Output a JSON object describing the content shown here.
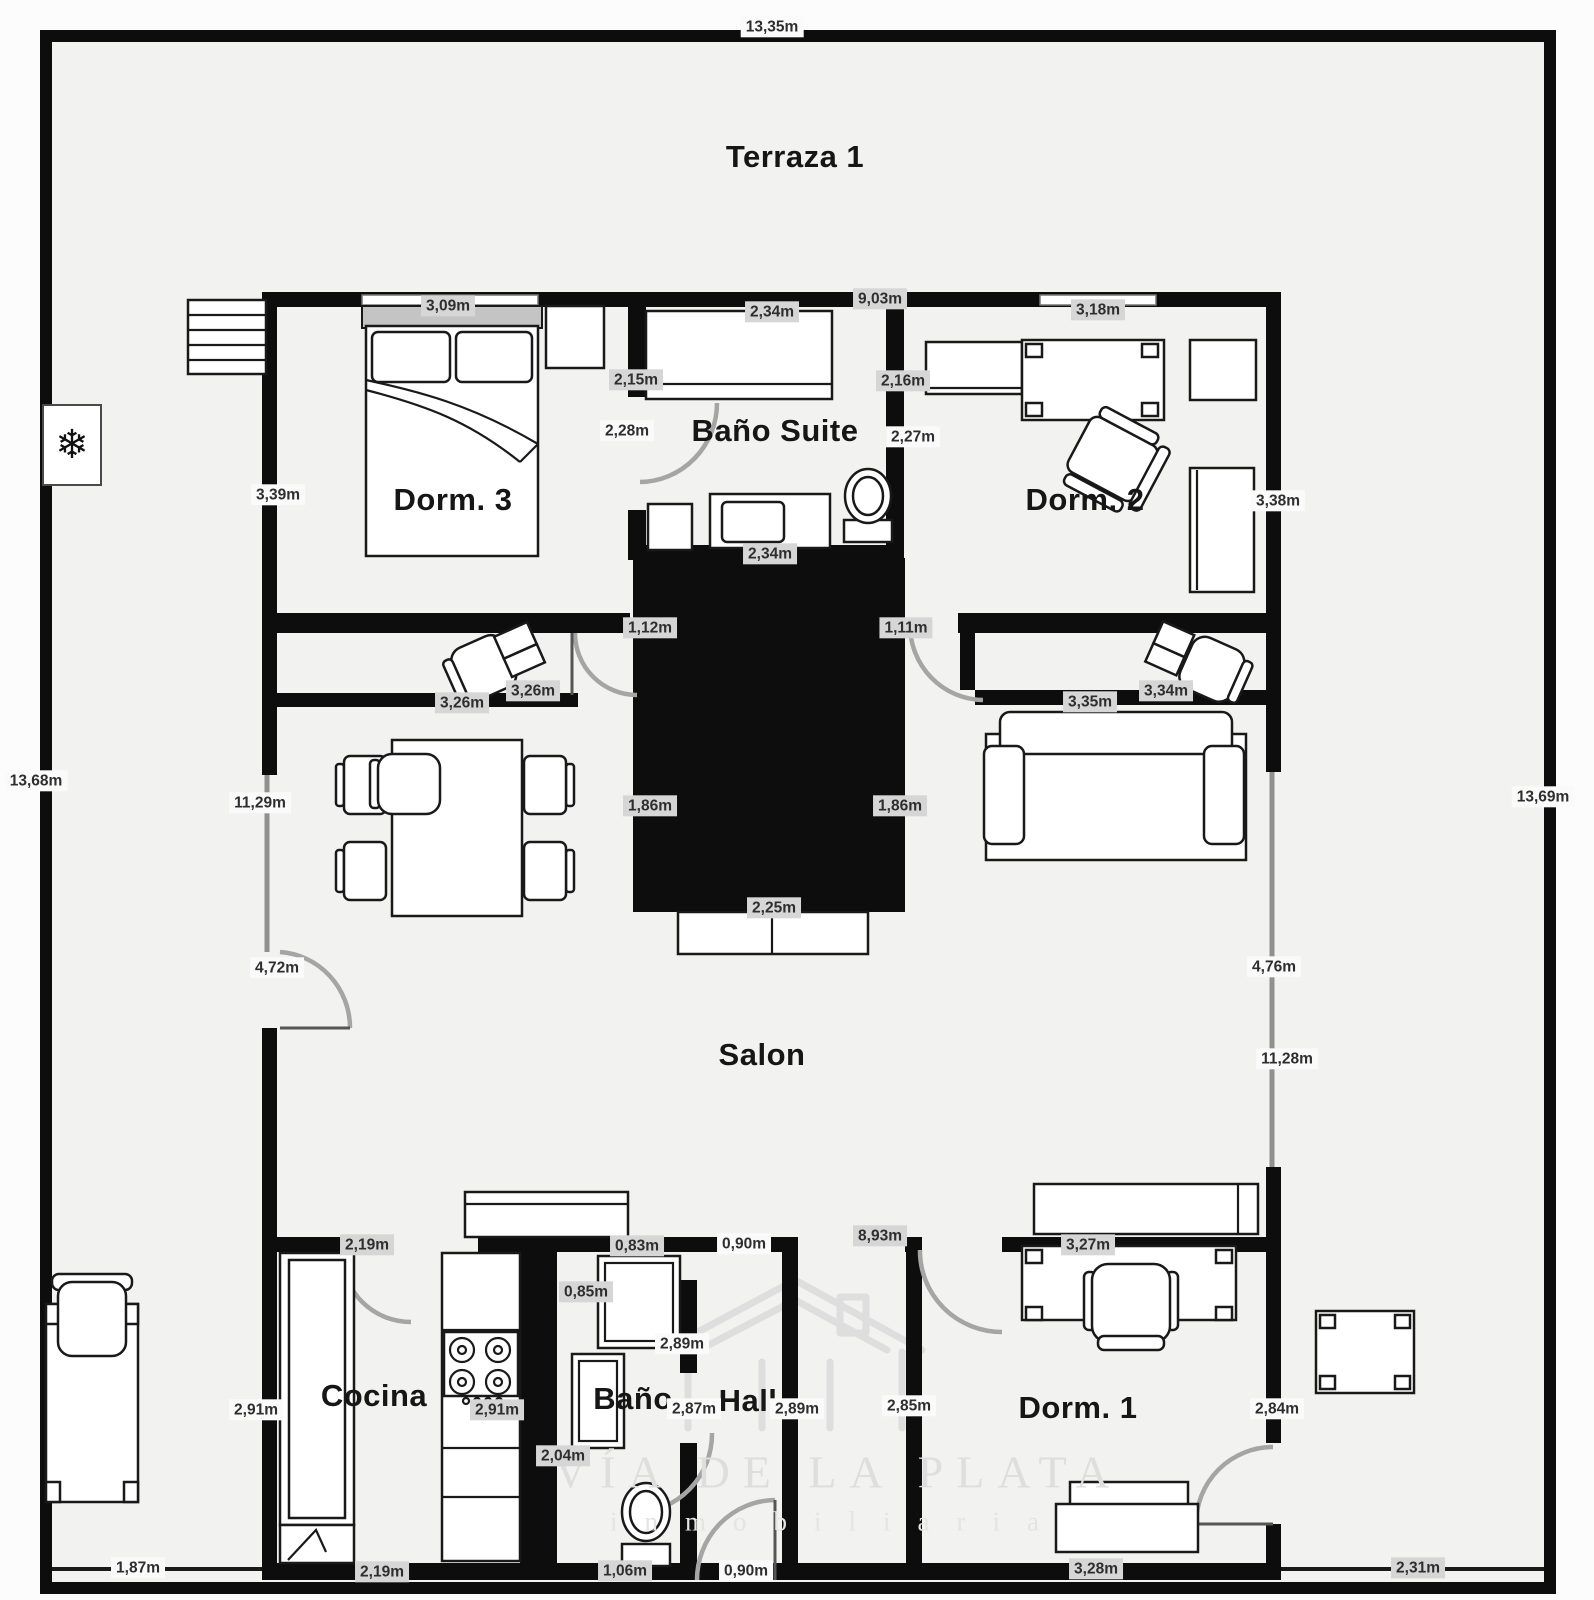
{
  "plan_title": "Floor plan",
  "watermark": {
    "line1": "VÍA DE LA PLATA",
    "line2": "inmobiliaria"
  },
  "icons": {
    "snowflake": "❄"
  },
  "colors": {
    "wall": "#0d0d0d",
    "floor": "#f2f2f1",
    "chip_background": "#d6d6d6",
    "plain_background": "#fafafa",
    "label_text": "#2e2e2e",
    "watermark": "#dedede"
  },
  "room_labels": [
    {
      "text": "Terraza 1",
      "x": 795,
      "y": 157
    },
    {
      "text": "Dorm. 3",
      "x": 453,
      "y": 500
    },
    {
      "text": "Baño Suite",
      "x": 775,
      "y": 431
    },
    {
      "text": "Dorm. 2",
      "x": 1085,
      "y": 500
    },
    {
      "text": "Salon",
      "x": 762,
      "y": 1055
    },
    {
      "text": "Cocina",
      "x": 374,
      "y": 1396
    },
    {
      "text": "Baño",
      "x": 633,
      "y": 1399
    },
    {
      "text": "Hall",
      "x": 748,
      "y": 1401
    },
    {
      "text": "Dorm. 1",
      "x": 1078,
      "y": 1408
    }
  ],
  "dimension_labels": [
    {
      "text": "13,35m",
      "x": 772,
      "y": 27,
      "style": "plain"
    },
    {
      "text": "13,68m",
      "x": 36,
      "y": 781,
      "style": "plain"
    },
    {
      "text": "13,69m",
      "x": 1543,
      "y": 797,
      "style": "plain"
    },
    {
      "text": "3,09m",
      "x": 448,
      "y": 306,
      "style": "chip"
    },
    {
      "text": "2,34m",
      "x": 772,
      "y": 312,
      "style": "chip"
    },
    {
      "text": "9,03m",
      "x": 880,
      "y": 299,
      "style": "chip"
    },
    {
      "text": "3,18m",
      "x": 1098,
      "y": 310,
      "style": "chip"
    },
    {
      "text": "2,15m",
      "x": 636,
      "y": 380,
      "style": "chip"
    },
    {
      "text": "2,16m",
      "x": 903,
      "y": 381,
      "style": "chip"
    },
    {
      "text": "2,28m",
      "x": 627,
      "y": 431,
      "style": "plain"
    },
    {
      "text": "2,27m",
      "x": 913,
      "y": 437,
      "style": "plain"
    },
    {
      "text": "3,39m",
      "x": 278,
      "y": 495,
      "style": "plain"
    },
    {
      "text": "3,38m",
      "x": 1278,
      "y": 501,
      "style": "plain"
    },
    {
      "text": "2,34m",
      "x": 770,
      "y": 554,
      "style": "chip"
    },
    {
      "text": "1,12m",
      "x": 650,
      "y": 628,
      "style": "chip"
    },
    {
      "text": "1,11m",
      "x": 906,
      "y": 628,
      "style": "chip"
    },
    {
      "text": "3,26m",
      "x": 533,
      "y": 691,
      "style": "chip"
    },
    {
      "text": "3,26m",
      "x": 462,
      "y": 703,
      "style": "chip"
    },
    {
      "text": "3,35m",
      "x": 1090,
      "y": 702,
      "style": "chip"
    },
    {
      "text": "3,34m",
      "x": 1166,
      "y": 691,
      "style": "chip"
    },
    {
      "text": "11,29m",
      "x": 260,
      "y": 803,
      "style": "plain"
    },
    {
      "text": "1,86m",
      "x": 650,
      "y": 806,
      "style": "chip"
    },
    {
      "text": "1,86m",
      "x": 900,
      "y": 806,
      "style": "chip"
    },
    {
      "text": "2,25m",
      "x": 774,
      "y": 908,
      "style": "chip"
    },
    {
      "text": "4,72m",
      "x": 277,
      "y": 968,
      "style": "plain"
    },
    {
      "text": "4,76m",
      "x": 1274,
      "y": 967,
      "style": "plain"
    },
    {
      "text": "11,28m",
      "x": 1287,
      "y": 1059,
      "style": "plain"
    },
    {
      "text": "2,19m",
      "x": 367,
      "y": 1245,
      "style": "chip"
    },
    {
      "text": "0,83m",
      "x": 637,
      "y": 1246,
      "style": "chip"
    },
    {
      "text": "0,90m",
      "x": 744,
      "y": 1244,
      "style": "plain"
    },
    {
      "text": "8,93m",
      "x": 880,
      "y": 1236,
      "style": "chip"
    },
    {
      "text": "3,27m",
      "x": 1088,
      "y": 1245,
      "style": "chip"
    },
    {
      "text": "2,91m",
      "x": 256,
      "y": 1410,
      "style": "plain"
    },
    {
      "text": "2,91m",
      "x": 497,
      "y": 1410,
      "style": "chip"
    },
    {
      "text": "0,85m",
      "x": 586,
      "y": 1292,
      "style": "chip"
    },
    {
      "text": "2,89m",
      "x": 682,
      "y": 1344,
      "style": "plain"
    },
    {
      "text": "2,87m",
      "x": 694,
      "y": 1409,
      "style": "plain"
    },
    {
      "text": "2,89m",
      "x": 797,
      "y": 1409,
      "style": "plain"
    },
    {
      "text": "2,85m",
      "x": 909,
      "y": 1406,
      "style": "plain"
    },
    {
      "text": "2,84m",
      "x": 1277,
      "y": 1409,
      "style": "plain"
    },
    {
      "text": "2,04m",
      "x": 563,
      "y": 1456,
      "style": "chip"
    },
    {
      "text": "1,87m",
      "x": 138,
      "y": 1568,
      "style": "plain"
    },
    {
      "text": "2,19m",
      "x": 382,
      "y": 1572,
      "style": "chip"
    },
    {
      "text": "1,06m",
      "x": 625,
      "y": 1571,
      "style": "chip"
    },
    {
      "text": "0,90m",
      "x": 746,
      "y": 1571,
      "style": "plain"
    },
    {
      "text": "3,28m",
      "x": 1096,
      "y": 1569,
      "style": "chip"
    },
    {
      "text": "2,31m",
      "x": 1418,
      "y": 1568,
      "style": "chip"
    }
  ]
}
